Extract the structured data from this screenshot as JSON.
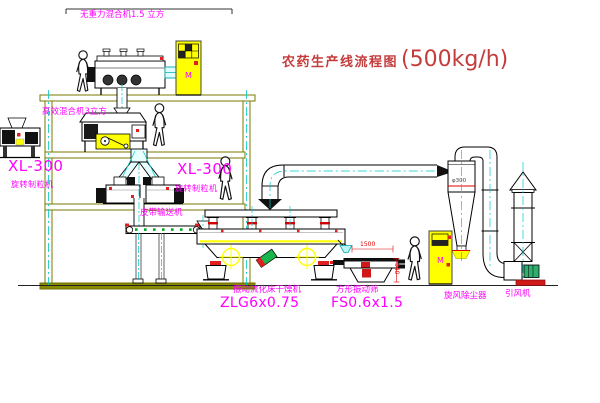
{
  "title": {
    "name": "农药生产线流程图",
    "capacity": "(500kg/h)"
  },
  "labels": {
    "gravityless_mixer": "无重力混合机1.5 立方",
    "high_efficiency_mixer": "高效混合机3立方",
    "granulator_left": {
      "model": "XL-300",
      "name": "旋转制粒机"
    },
    "granulator_center": {
      "model": "XL-300",
      "name": "旋转制粒机"
    },
    "belt_conveyor": "皮带输送机",
    "fluid_bed_dryer": {
      "name": "振动流化床干燥机",
      "model": "ZLG6x0.75"
    },
    "square_vibrating_sieve": {
      "name": "方形振动筛",
      "model": "FS0.6x1.5"
    },
    "cyclone_dust_collector": "旋风除尘器",
    "induced_draft_fan": "引风机"
  },
  "dimensions": {
    "sieve_length": "1500",
    "sieve_height": "340",
    "cyclone_note": "φ300"
  },
  "cabinets": {
    "cabinet_a_mark": "M",
    "cabinet_b_mark": "M"
  },
  "colors": {
    "label_magenta": "#ff00ff",
    "title_red": "#c43c3c",
    "structure_olive": "#787800",
    "centerline_cyan": "#00c8c8",
    "equipment_yellow": "#ffff00",
    "accent_red": "#e02020",
    "accent_green": "#00aa22"
  }
}
